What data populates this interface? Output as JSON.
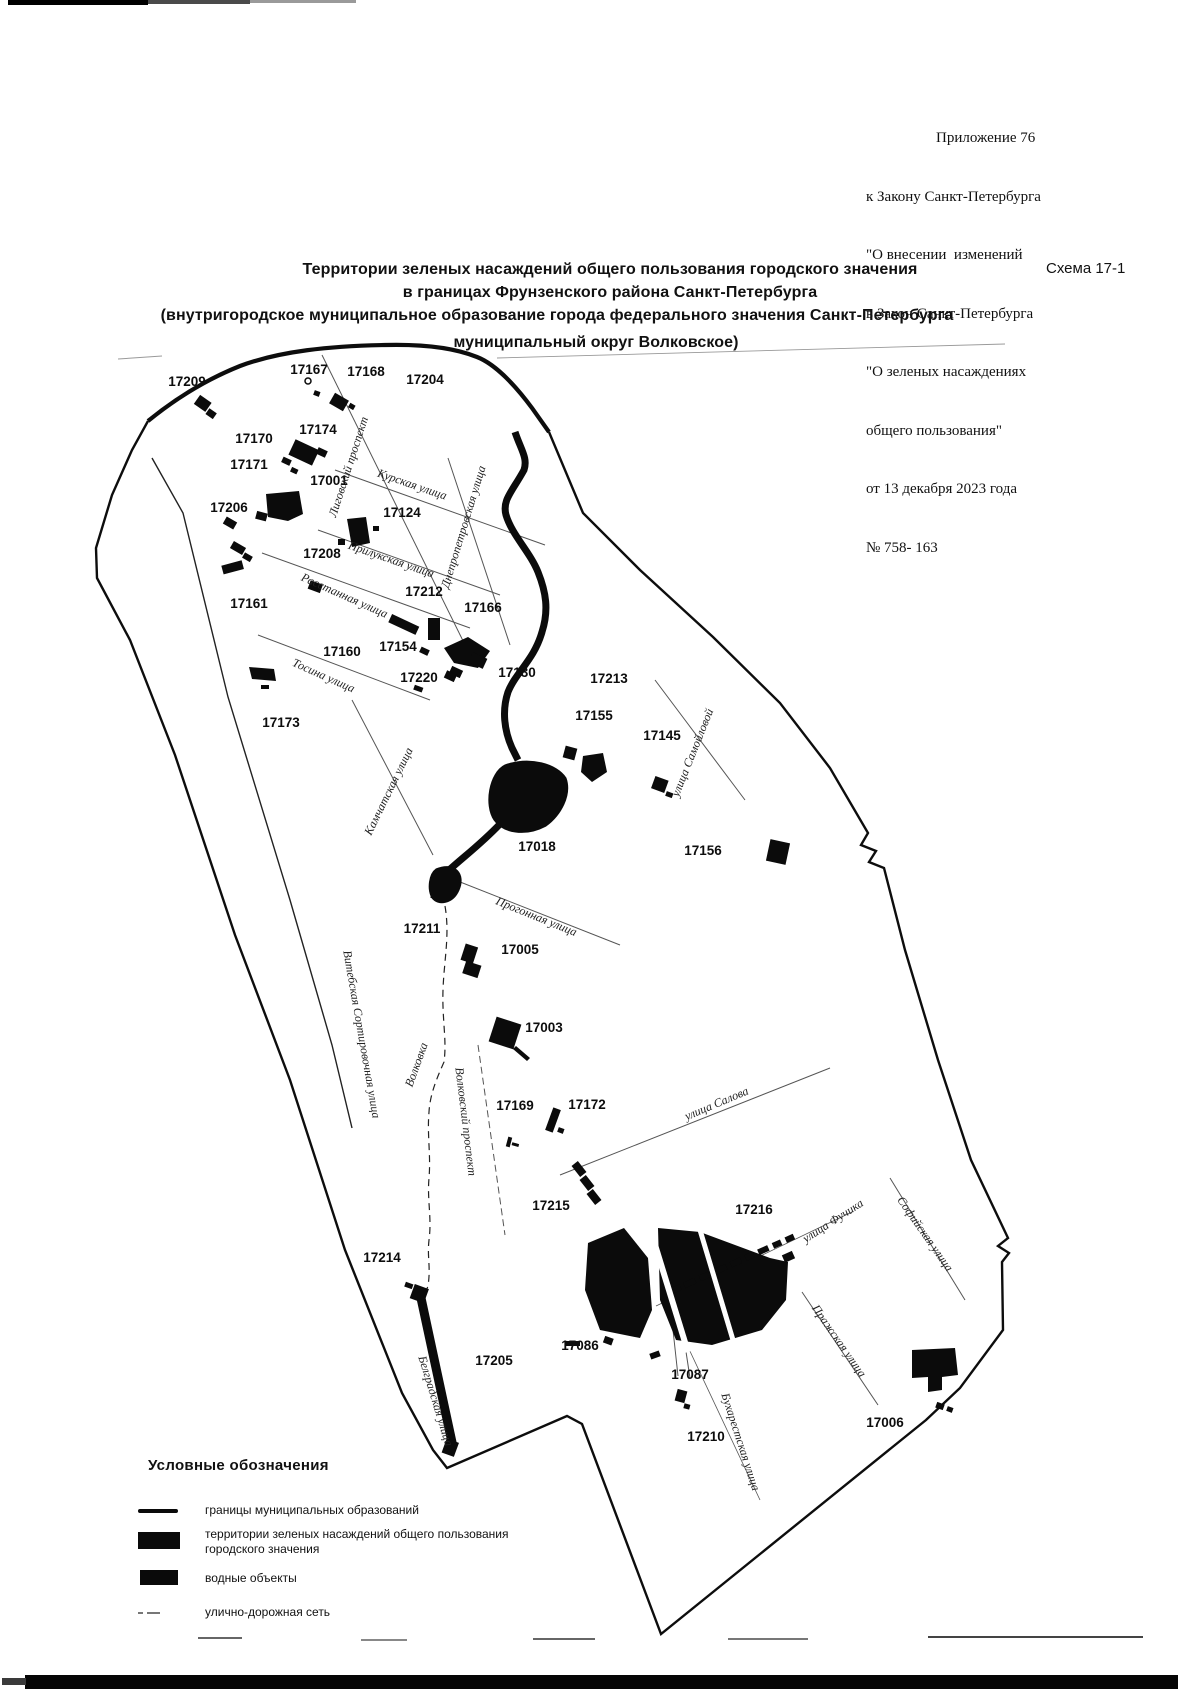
{
  "appendix": {
    "lines": [
      "Приложение 76",
      "к Закону Санкт-Петербурга",
      "\"О внесении  изменений",
      "в Закон Санкт-Петербурга",
      "\"О зеленых насаждениях",
      "общего пользования\"",
      "от 13 декабря 2023 года",
      "№ 758- 163"
    ]
  },
  "scheme_label": "Схема 17-1",
  "title": {
    "line1": "Территории зеленых насаждений общего пользования городского значения",
    "line2": "в границах Фрунзенского района Санкт-Петербурга",
    "line3": "(внутригородское муниципальное образование города федерального значения Санкт-Петербурга",
    "line4": "муниципальный округ Волковское)"
  },
  "legend": {
    "header": "Условные обозначения",
    "items": [
      {
        "label": "границы муниципальных образований",
        "label2": "",
        "symbol": "boundary-line"
      },
      {
        "label": "территории зеленых насаждений общего пользования",
        "label2": "городского значения",
        "symbol": "green-territory-fill"
      },
      {
        "label": "водные объекты",
        "label2": "",
        "symbol": "water-fill"
      },
      {
        "label": "улично-дорожная сеть",
        "label2": "",
        "symbol": "street-network-line"
      }
    ]
  },
  "map": {
    "areas": [
      {
        "id": "17209",
        "x": 187,
        "y": 386
      },
      {
        "id": "17167",
        "x": 309,
        "y": 374
      },
      {
        "id": "17168",
        "x": 366,
        "y": 376
      },
      {
        "id": "17204",
        "x": 425,
        "y": 384
      },
      {
        "id": "17170",
        "x": 254,
        "y": 443
      },
      {
        "id": "17174",
        "x": 318,
        "y": 434
      },
      {
        "id": "17171",
        "x": 249,
        "y": 469
      },
      {
        "id": "17001",
        "x": 329,
        "y": 485
      },
      {
        "id": "17206",
        "x": 229,
        "y": 512
      },
      {
        "id": "17124",
        "x": 402,
        "y": 517
      },
      {
        "id": "17208",
        "x": 322,
        "y": 558
      },
      {
        "id": "17212",
        "x": 424,
        "y": 596
      },
      {
        "id": "17161",
        "x": 249,
        "y": 608
      },
      {
        "id": "17166",
        "x": 483,
        "y": 612
      },
      {
        "id": "17154",
        "x": 398,
        "y": 651
      },
      {
        "id": "17160",
        "x": 342,
        "y": 656
      },
      {
        "id": "17220",
        "x": 419,
        "y": 682
      },
      {
        "id": "17130",
        "x": 517,
        "y": 677
      },
      {
        "id": "17213",
        "x": 609,
        "y": 683
      },
      {
        "id": "17155",
        "x": 594,
        "y": 720
      },
      {
        "id": "17145",
        "x": 662,
        "y": 740
      },
      {
        "id": "17173",
        "x": 281,
        "y": 727
      },
      {
        "id": "17018",
        "x": 537,
        "y": 851
      },
      {
        "id": "17156",
        "x": 703,
        "y": 855
      },
      {
        "id": "17211",
        "x": 422,
        "y": 933
      },
      {
        "id": "17005",
        "x": 520,
        "y": 954
      },
      {
        "id": "17003",
        "x": 544,
        "y": 1032
      },
      {
        "id": "17169",
        "x": 515,
        "y": 1110
      },
      {
        "id": "17172",
        "x": 587,
        "y": 1109
      },
      {
        "id": "17215",
        "x": 551,
        "y": 1210
      },
      {
        "id": "17216",
        "x": 754,
        "y": 1214
      },
      {
        "id": "17214",
        "x": 382,
        "y": 1262
      },
      {
        "id": "17205",
        "x": 494,
        "y": 1365
      },
      {
        "id": "17086",
        "x": 580,
        "y": 1350
      },
      {
        "id": "17087",
        "x": 690,
        "y": 1379
      },
      {
        "id": "17210",
        "x": 706,
        "y": 1441
      },
      {
        "id": "17006",
        "x": 885,
        "y": 1427
      }
    ],
    "streets": [
      {
        "name": "Лиговский проспект",
        "x": 352,
        "y": 468,
        "r": -72
      },
      {
        "name": "Курская улица",
        "x": 411,
        "y": 488,
        "r": 19
      },
      {
        "name": "Днепропетровская улица",
        "x": 467,
        "y": 528,
        "r": -73
      },
      {
        "name": "Прилукская улица",
        "x": 390,
        "y": 563,
        "r": 19
      },
      {
        "name": "Расстанная улица",
        "x": 343,
        "y": 599,
        "r": 24
      },
      {
        "name": "Тосина улица",
        "x": 322,
        "y": 679,
        "r": 24
      },
      {
        "name": "Камчатская улица",
        "x": 392,
        "y": 793,
        "r": -64
      },
      {
        "name": "улица Самойловой",
        "x": 696,
        "y": 754,
        "r": -68
      },
      {
        "name": "Прогонная улица",
        "x": 535,
        "y": 920,
        "r": 22
      },
      {
        "name": "Витебская Сортировочная улица",
        "x": 358,
        "y": 1035,
        "r": 80
      },
      {
        "name": "Волковка",
        "x": 420,
        "y": 1066,
        "r": -70
      },
      {
        "name": "Волковский проспект",
        "x": 462,
        "y": 1122,
        "r": 83
      },
      {
        "name": "улица Салова",
        "x": 718,
        "y": 1107,
        "r": -23
      },
      {
        "name": "улица Фучика",
        "x": 835,
        "y": 1224,
        "r": -33
      },
      {
        "name": "Софийская улица",
        "x": 922,
        "y": 1236,
        "r": 55
      },
      {
        "name": "Пражская улица",
        "x": 836,
        "y": 1343,
        "r": 55
      },
      {
        "name": "Бухарестская улица",
        "x": 737,
        "y": 1443,
        "r": 72
      },
      {
        "name": "Белградская улица",
        "x": 432,
        "y": 1402,
        "r": 73
      }
    ]
  },
  "colors": {
    "ink": "#0d0d0d",
    "faint": "#999999"
  }
}
